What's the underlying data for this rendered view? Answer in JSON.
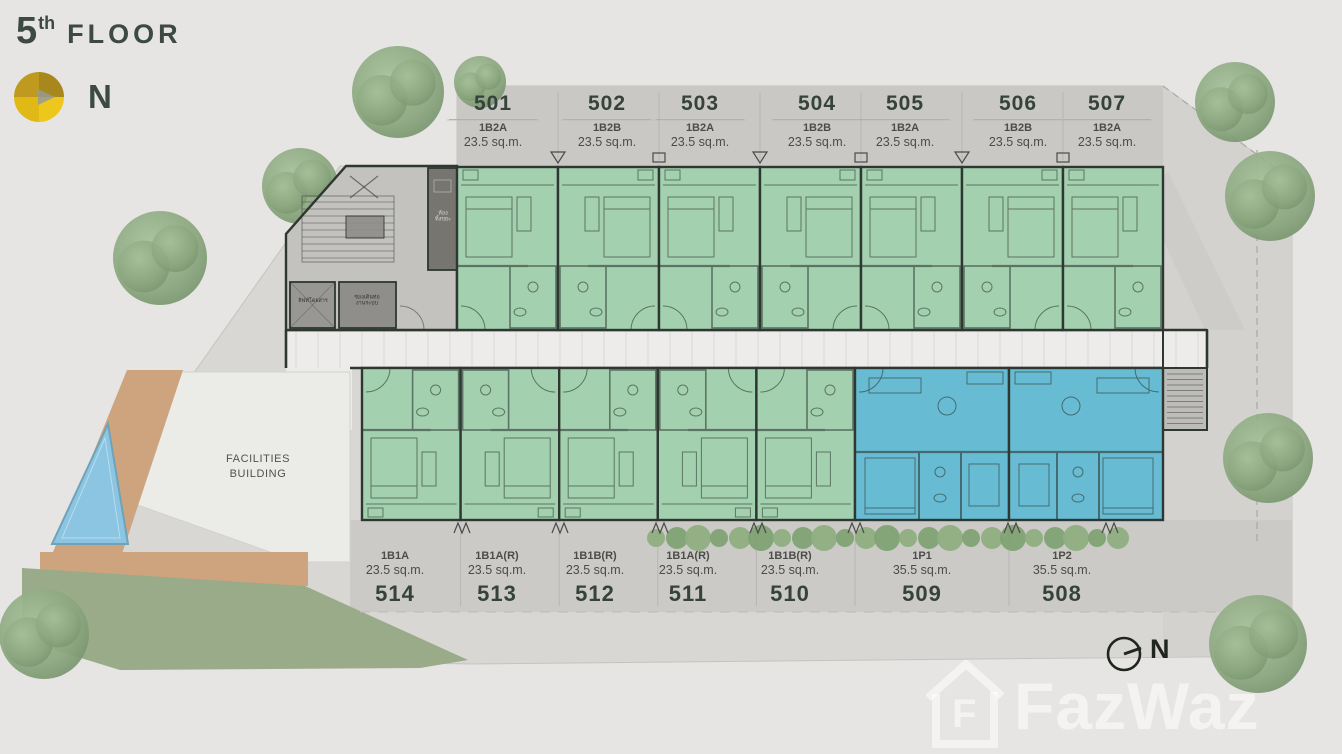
{
  "page": {
    "floor_number": "5",
    "floor_ordinal": "th",
    "floor_word": "FLOOR"
  },
  "compass": {
    "north_label": "N"
  },
  "facilities": {
    "line1": "FACILITIES",
    "line2": "BUILDING"
  },
  "units_top": [
    {
      "number": "501",
      "type": "1B2A",
      "area": "23.5 sq.m."
    },
    {
      "number": "502",
      "type": "1B2B",
      "area": "23.5 sq.m."
    },
    {
      "number": "503",
      "type": "1B2A",
      "area": "23.5 sq.m."
    },
    {
      "number": "504",
      "type": "1B2B",
      "area": "23.5 sq.m."
    },
    {
      "number": "505",
      "type": "1B2A",
      "area": "23.5 sq.m."
    },
    {
      "number": "506",
      "type": "1B2B",
      "area": "23.5 sq.m."
    },
    {
      "number": "507",
      "type": "1B2A",
      "area": "23.5 sq.m."
    }
  ],
  "units_bottom": [
    {
      "number": "514",
      "type": "1B1A",
      "area": "23.5 sq.m."
    },
    {
      "number": "513",
      "type": "1B1A(R)",
      "area": "23.5 sq.m."
    },
    {
      "number": "512",
      "type": "1B1B(R)",
      "area": "23.5 sq.m."
    },
    {
      "number": "511",
      "type": "1B1A(R)",
      "area": "23.5 sq.m."
    },
    {
      "number": "510",
      "type": "1B1B(R)",
      "area": "23.5 sq.m."
    },
    {
      "number": "509",
      "type": "1P1",
      "area": "35.5 sq.m."
    },
    {
      "number": "508",
      "type": "1P2",
      "area": "35.5 sq.m."
    }
  ],
  "core_rooms": {
    "lift": "ลิฟท์โดยสาร",
    "shaft_line1": "ช่องเดินท่อ",
    "shaft_line2": "งานระบบ",
    "trash_line1": "ห้อง",
    "trash_line2": "ทิ้งขยะ"
  },
  "watermark": {
    "logo_letter": "F",
    "brand": "FazWaz"
  },
  "colors": {
    "unit_green": "#a3d1af",
    "unit_blue": "#67bcd4",
    "wall": "#2e3731",
    "gold": "#d9ad1b",
    "title_text": "#3c4944"
  }
}
